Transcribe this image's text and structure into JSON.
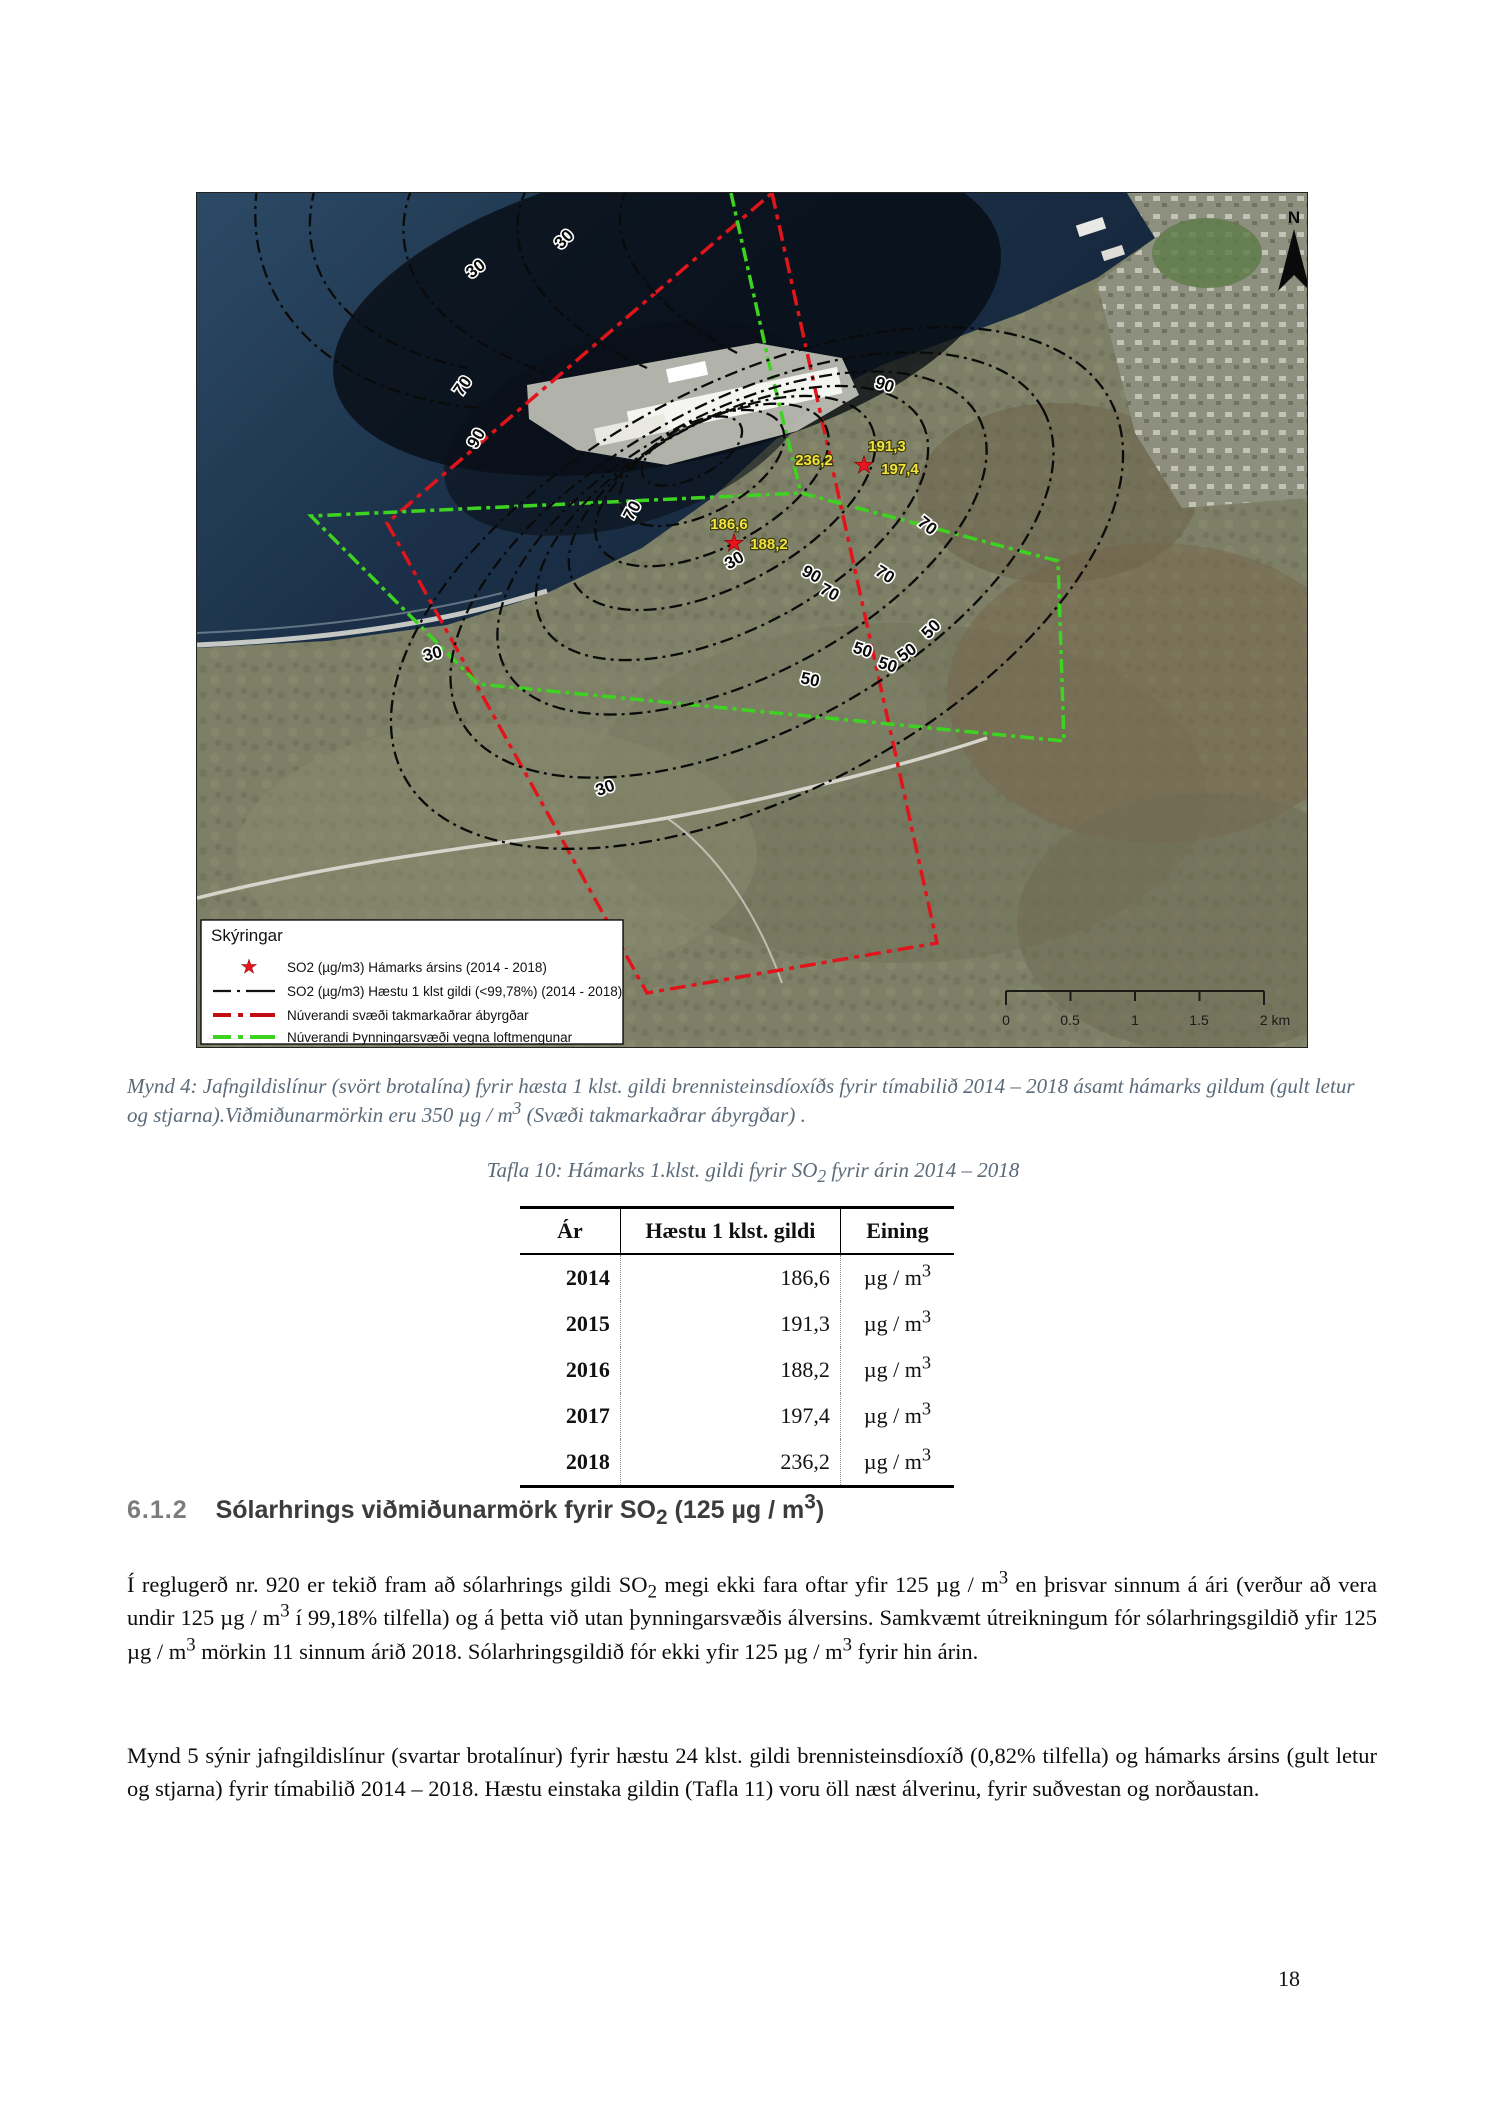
{
  "map": {
    "legend": {
      "title": "Skýringar",
      "items": [
        "SO2 (µg/m3) Hámarks ársins (2014 - 2018)",
        "SO2 (µg/m3) Hæstu 1 klst gildi (<99,78%) (2014 - 2018)",
        "Núverandi svæði takmarkaðrar ábyrgðar",
        "Núverandi Þynningarsvæði vegna loftmengunar"
      ]
    },
    "north_label": "N",
    "scale_labels": [
      "0",
      "0.5",
      "1",
      "1.5",
      "2 km"
    ],
    "contour_labels": [
      "30",
      "30",
      "90",
      "70",
      "70",
      "90",
      "70",
      "70",
      "50",
      "50",
      "50",
      "50",
      "50",
      "70",
      "90",
      "30",
      "30",
      "30"
    ],
    "station_labels": [
      "236,2",
      "191,3",
      "197,4",
      "186,6",
      "188,2"
    ],
    "star_glyph": "★"
  },
  "caption": {
    "part1": "Mynd 4: Jafngildislínur (svört brotalína) fyrir hæsta 1 klst. gildi brennisteinsdíoxíðs fyrir tímabilið 2014 – 2018 ásamt hámarks gildum (gult letur og stjarna).Viðmiðunarmörkin eru 350 µg / m",
    "sup": "3",
    "part2": " (Svæði takmarkaðrar ábyrgðar) ."
  },
  "table": {
    "title_part1": "Tafla 10: Hámarks 1.klst. gildi  fyrir SO",
    "title_sub": "2",
    "title_part2": " fyrir árin 2014 – 2018",
    "headers": [
      "Ár",
      "Hæstu 1 klst. gildi",
      "Eining"
    ],
    "unit_base": "µg / m",
    "unit_sup": "3",
    "rows": [
      {
        "year": "2014",
        "value": "186,6"
      },
      {
        "year": "2015",
        "value": "191,3"
      },
      {
        "year": "2016",
        "value": "188,2"
      },
      {
        "year": "2017",
        "value": "197,4"
      },
      {
        "year": "2018",
        "value": "236,2"
      }
    ]
  },
  "section": {
    "number": "6.1.2",
    "title_part1": "Sólarhrings viðmiðunarmörk fyrir SO",
    "title_sub": "2",
    "title_part2": " (125 µg / m",
    "title_sup": "3",
    "title_part3": ")"
  },
  "paragraph1": {
    "s1": "Í reglugerð nr. 920 er tekið fram að sólarhrings gildi SO",
    "sub1": "2",
    "s2": " megi ekki fara oftar yfir 125 µg / m",
    "sup1": "3",
    "s3": " en þrisvar sinnum á ári (verður að vera undir 125 µg / m",
    "sup2": "3",
    "s4": " í 99,18% tilfella) og á þetta við utan þynningarsvæðis álversins. Samkvæmt útreikningum fór sólarhringsgildið yfir 125 µg / m",
    "sup3": "3",
    "s5": " mörkin 11 sinnum árið 2018. Sólarhringsgildið fór ekki yfir 125 µg / m",
    "sup4": "3",
    "s6": " fyrir hin árin."
  },
  "paragraph2": "Mynd 5 sýnir jafngildislínur (svartar brotalínur) fyrir hæstu 24 klst. gildi brennisteinsdíoxíð (0,82% tilfella) og hámarks ársins  (gult letur og stjarna) fyrir tímabilið 2014 – 2018. Hæstu einstaka gildin (Tafla 11) voru öll næst álverinu, fyrir suðvestan og norðaustan.",
  "page_number": "18"
}
